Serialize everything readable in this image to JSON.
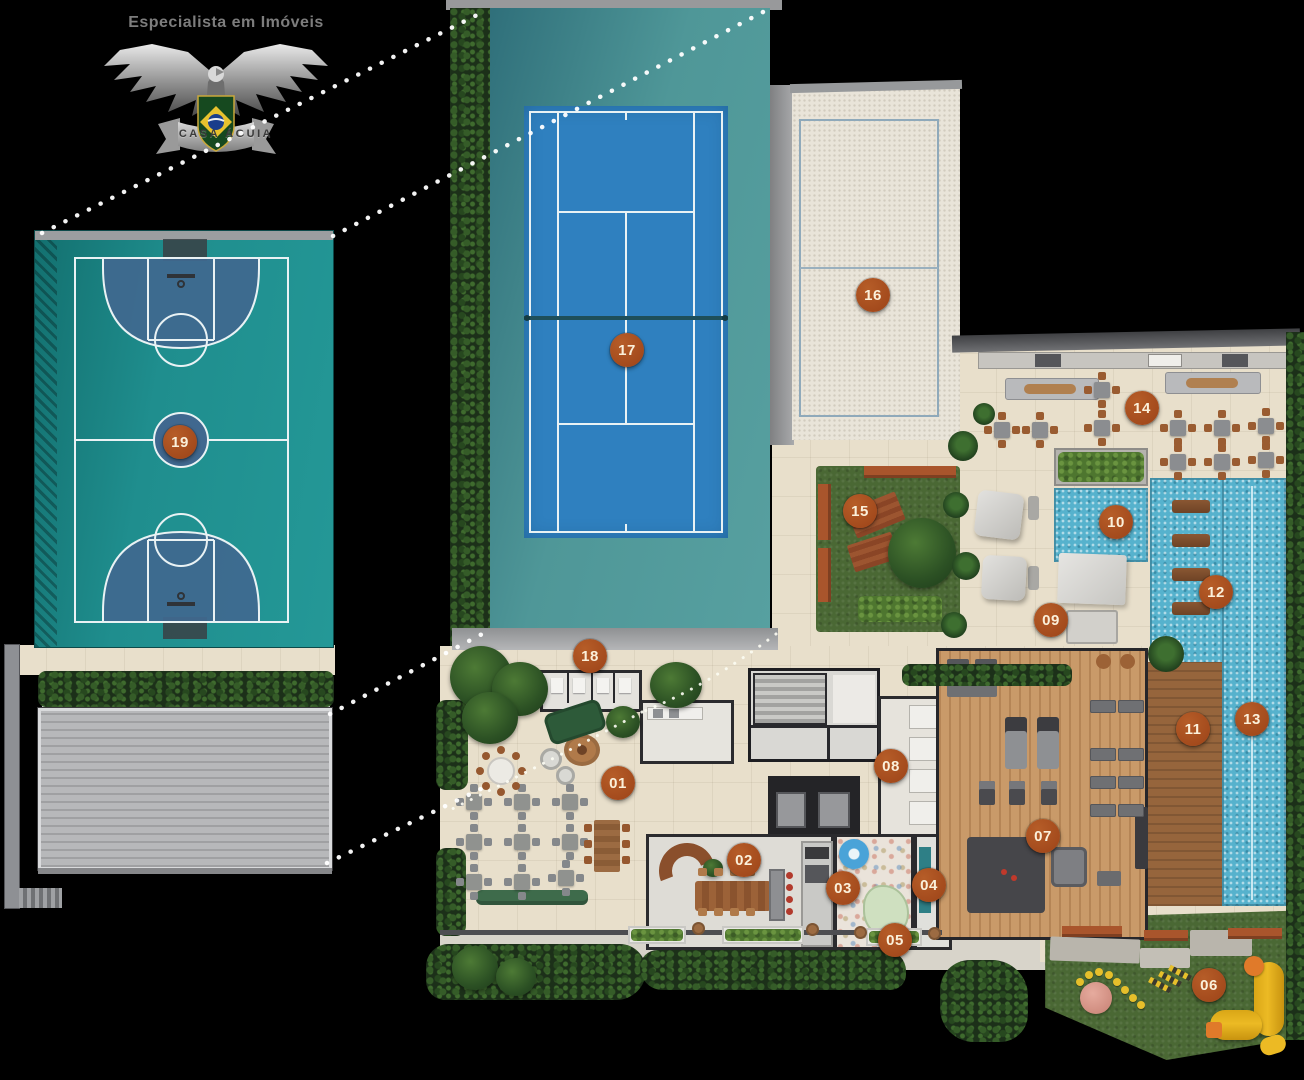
{
  "logo": {
    "tagline": "Especialista em Imóveis",
    "banner": "CASA ÁGUIA"
  },
  "markers": [
    {
      "label": "01",
      "x": 618,
      "y": 783
    },
    {
      "label": "02",
      "x": 744,
      "y": 860
    },
    {
      "label": "03",
      "x": 843,
      "y": 888
    },
    {
      "label": "04",
      "x": 929,
      "y": 885
    },
    {
      "label": "05",
      "x": 895,
      "y": 940
    },
    {
      "label": "06",
      "x": 1209,
      "y": 985
    },
    {
      "label": "07",
      "x": 1043,
      "y": 836
    },
    {
      "label": "08",
      "x": 891,
      "y": 766
    },
    {
      "label": "09",
      "x": 1051,
      "y": 620
    },
    {
      "label": "10",
      "x": 1116,
      "y": 522
    },
    {
      "label": "11",
      "x": 1193,
      "y": 729
    },
    {
      "label": "12",
      "x": 1216,
      "y": 592
    },
    {
      "label": "13",
      "x": 1252,
      "y": 719
    },
    {
      "label": "14",
      "x": 1142,
      "y": 408
    },
    {
      "label": "15",
      "x": 860,
      "y": 511
    },
    {
      "label": "16",
      "x": 873,
      "y": 295
    },
    {
      "label": "17",
      "x": 627,
      "y": 350
    },
    {
      "label": "18",
      "x": 590,
      "y": 656
    },
    {
      "label": "19",
      "x": 180,
      "y": 442
    }
  ],
  "palette": {
    "background": "#000000",
    "marker_fill": "#a7501e",
    "marker_text": "#fbf0da",
    "tennis_court_blue": "#2f80bf",
    "sport_surround_teal": "#4f9798",
    "basketball_teal": "#1f8e8e",
    "court_zone_blue": "#40688f",
    "pool_water": "#56b2cd",
    "lawn_green": "#4a6834",
    "sand": "#e9e4d9",
    "floor_beige": "#e8dfcb",
    "deck_wood": "#96653c",
    "gym_wood": "#c99a69"
  }
}
